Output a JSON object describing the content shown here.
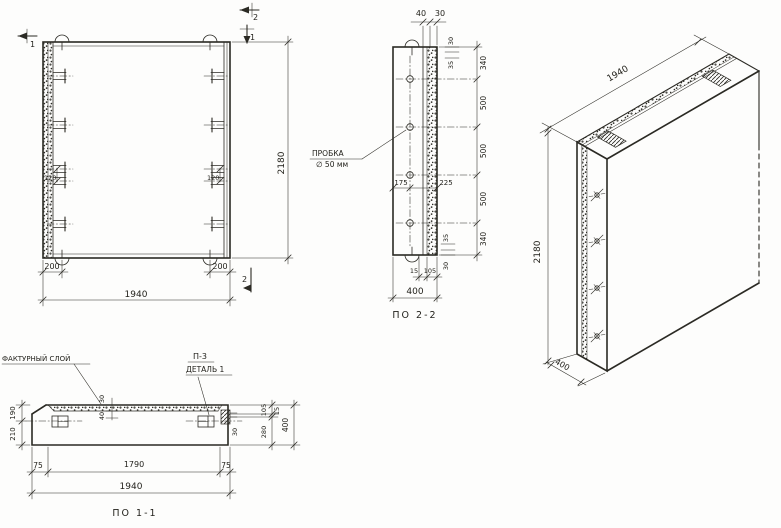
{
  "front_view": {
    "mark_1_top": "1",
    "mark_2_top": "2",
    "mark_1_right": "1",
    "mark_2_bottom": "2",
    "dim_height": "2180",
    "dim_width": "1940",
    "dim_offset_left": "200",
    "dim_offset_right": "200",
    "dim_loop_left": "120",
    "dim_loop_right": "120"
  },
  "section_2": {
    "title": "ПО 2-2",
    "dim_40": "40",
    "dim_30": "30",
    "small_30_top": "30",
    "small_35_top": "35",
    "right_dims": [
      "340",
      "500",
      "500",
      "500",
      "340"
    ],
    "plug_line1": "ПРОБКА",
    "plug_line2": "∅ 50 мм",
    "dim_175": "175",
    "dim_225": "225",
    "small_35_bottom": "35",
    "small_30_bottom": "30",
    "dim_15": "15",
    "dim_105": "105",
    "dim_400": "400"
  },
  "section_1": {
    "title": "ПО 1-1",
    "label_facture": "ФАКТУРНЫЙ СЛОЙ",
    "label_p3": "П-3",
    "label_detail": "ДЕТАЛЬ 1",
    "dim_30_layer": "30",
    "dim_40_layer": "40",
    "dim_190": "190",
    "dim_210": "210",
    "dim_30_plate": "30",
    "dim_105": "105",
    "dim_15": "15",
    "dim_280": "280",
    "dim_400": "400",
    "dim_75_left": "75",
    "dim_1790": "1790",
    "dim_75_right": "75",
    "dim_1940": "1940"
  },
  "axon": {
    "dim_width": "1940",
    "dim_height": "2180",
    "dim_depth": "400"
  }
}
